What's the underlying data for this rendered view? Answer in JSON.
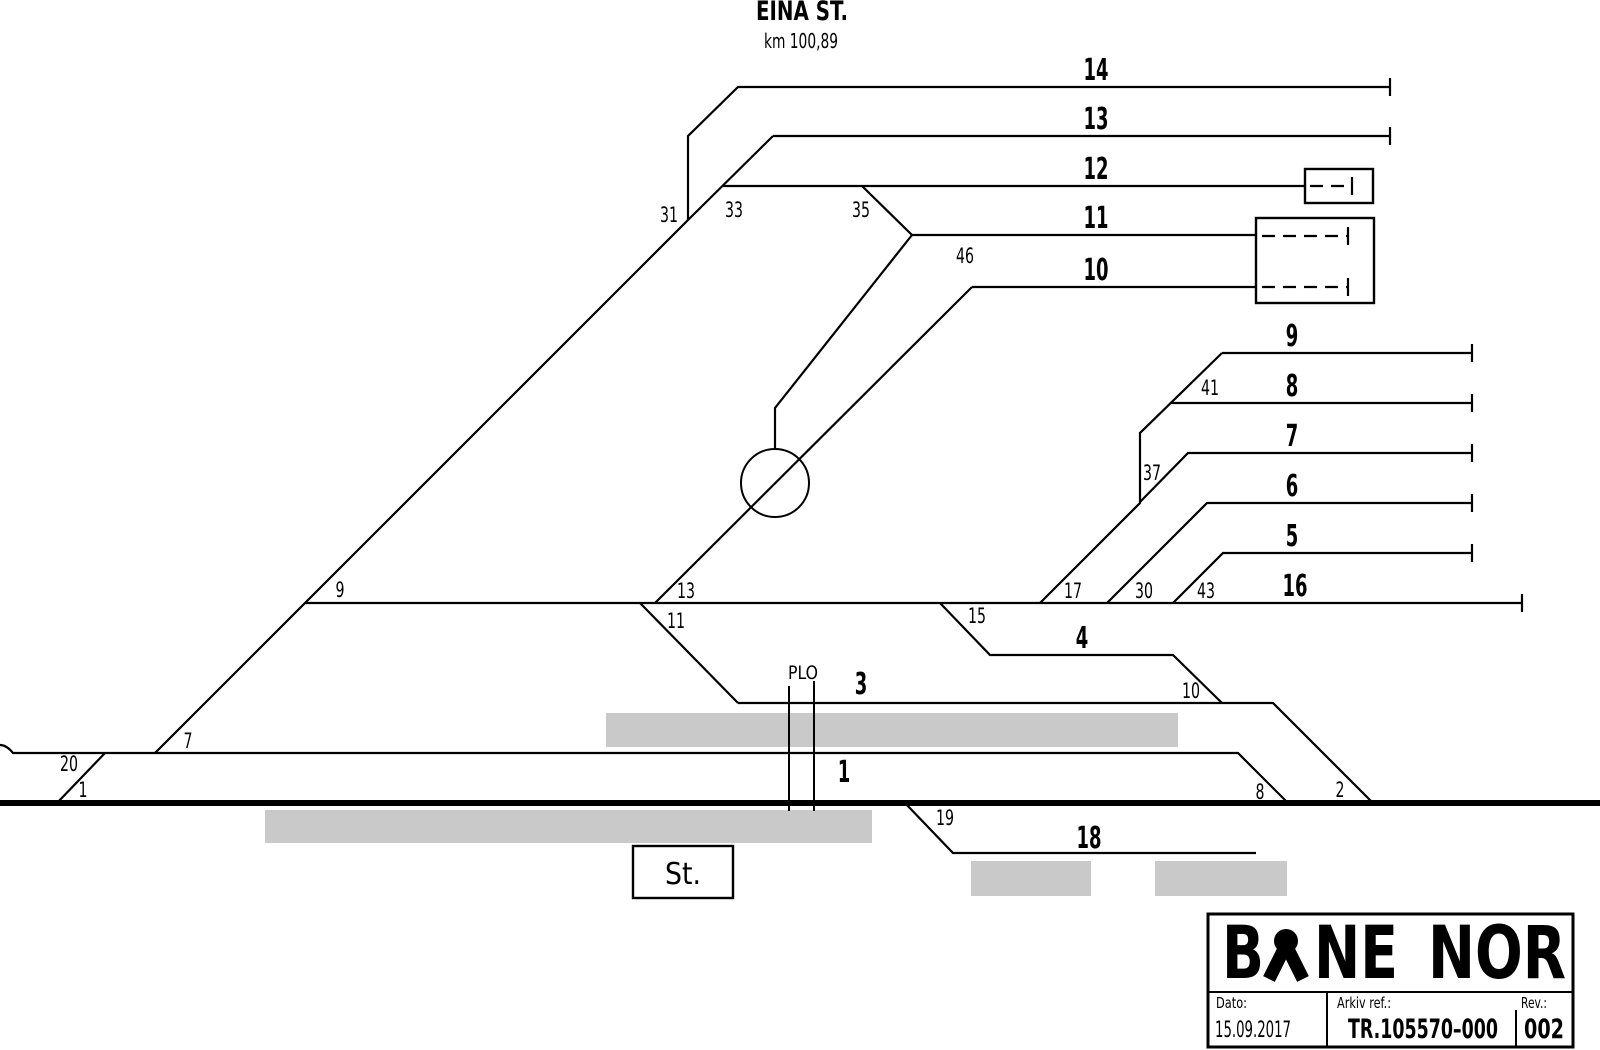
{
  "station": {
    "title": "EINA ST.",
    "km_label": "km 100,89"
  },
  "annotations": {
    "plo": "PLO",
    "station_building": "St."
  },
  "track_labels": [
    {
      "text": "14",
      "x": 1096,
      "y": 80
    },
    {
      "text": "13",
      "x": 1096,
      "y": 129
    },
    {
      "text": "12",
      "x": 1096,
      "y": 179
    },
    {
      "text": "11",
      "x": 1096,
      "y": 228
    },
    {
      "text": "10",
      "x": 1096,
      "y": 280
    },
    {
      "text": "9",
      "x": 1292,
      "y": 346
    },
    {
      "text": "8",
      "x": 1292,
      "y": 396
    },
    {
      "text": "7",
      "x": 1292,
      "y": 446
    },
    {
      "text": "6",
      "x": 1292,
      "y": 496
    },
    {
      "text": "5",
      "x": 1292,
      "y": 546
    },
    {
      "text": "16",
      "x": 1295,
      "y": 596
    },
    {
      "text": "4",
      "x": 1082,
      "y": 648
    },
    {
      "text": "3",
      "x": 861,
      "y": 694
    },
    {
      "text": "1",
      "x": 844,
      "y": 782
    },
    {
      "text": "18",
      "x": 1089,
      "y": 848
    }
  ],
  "switch_labels": [
    {
      "text": "31",
      "x": 669,
      "y": 222
    },
    {
      "text": "33",
      "x": 734,
      "y": 217
    },
    {
      "text": "35",
      "x": 861,
      "y": 217
    },
    {
      "text": "46",
      "x": 965,
      "y": 263
    },
    {
      "text": "41",
      "x": 1210,
      "y": 395
    },
    {
      "text": "37",
      "x": 1152,
      "y": 480
    },
    {
      "text": "17",
      "x": 1073,
      "y": 598
    },
    {
      "text": "30",
      "x": 1144,
      "y": 598
    },
    {
      "text": "43",
      "x": 1206,
      "y": 598
    },
    {
      "text": "15",
      "x": 977,
      "y": 623
    },
    {
      "text": "13",
      "x": 686,
      "y": 598
    },
    {
      "text": "11",
      "x": 676,
      "y": 628
    },
    {
      "text": "9",
      "x": 340,
      "y": 597
    },
    {
      "text": "7",
      "x": 188,
      "y": 748
    },
    {
      "text": "20",
      "x": 69,
      "y": 771
    },
    {
      "text": "1",
      "x": 83,
      "y": 797
    },
    {
      "text": "10",
      "x": 1191,
      "y": 698
    },
    {
      "text": "8",
      "x": 1260,
      "y": 799
    },
    {
      "text": "2",
      "x": 1340,
      "y": 797
    },
    {
      "text": "19",
      "x": 945,
      "y": 825
    }
  ],
  "title_block": {
    "logo_left": "B",
    "logo_mid": "NE",
    "logo_right": "NOR",
    "date_label": "Dato:",
    "date_value": "15.09.2017",
    "archive_label": "Arkiv ref.:",
    "archive_value": "TR.105570–000",
    "rev_label": "Rev.:",
    "rev_value": "002"
  },
  "colors": {
    "line": "#000000",
    "platform": "#c9c9c9",
    "background": "#ffffff"
  }
}
